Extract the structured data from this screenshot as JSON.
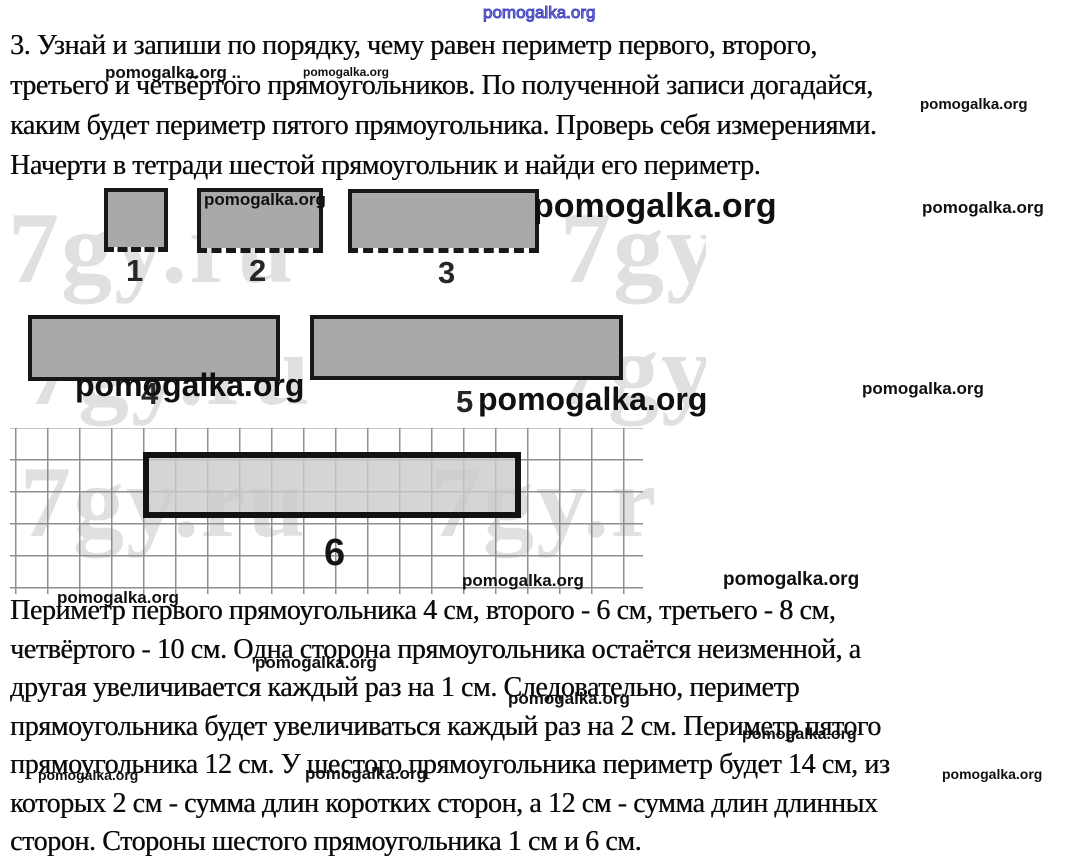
{
  "task": {
    "lines": [
      "3. Узнай и запиши по порядку, чему равен периметр первого, второго,",
      "третьего и четвёртого прямоугольников. По полученной записи догадайся,",
      "каким будет периметр пятого прямоугольника. Проверь себя измерениями.",
      "Начерти в тетради шестой прямоугольник и найди его периметр."
    ]
  },
  "figure": {
    "rect_labels": [
      "1",
      "2",
      "3",
      "4",
      "5",
      "6"
    ],
    "colors": {
      "rect_fill": "#a9a9a9",
      "rect_border": "#181818",
      "rect6_fill": "#d0d0d0",
      "grid_line": "#8f8f8f",
      "background_watermark": "#e0e0e0",
      "blue_watermark": "#4343c0"
    }
  },
  "answer": {
    "lines": [
      "Периметр первого прямоугольника 4 см, второго - 6 см, третьего - 8 см,",
      "четвёртого - 10 см. Одна сторона прямоугольника остаётся неизменной, а",
      "другая увеличивается каждый раз на 1 см. Следовательно, периметр",
      "прямоугольника будет увеличиваться каждый раз на 2 см. Периметр пятого",
      "прямоугольника 12 см. У шестого прямоугольника периметр будет 14 см, из",
      "которых 2 см - сумма длин коротких сторон, а 12 см - сумма длин длинных",
      "сторон. Стороны шестого прямоугольника 1 см и 6 см."
    ]
  },
  "watermarks": {
    "site": "pomogalka.org",
    "site_with_dots": "pomogalka.org ..",
    "background_site": "7gy.ru",
    "background_site_partial": "7gy.r"
  }
}
